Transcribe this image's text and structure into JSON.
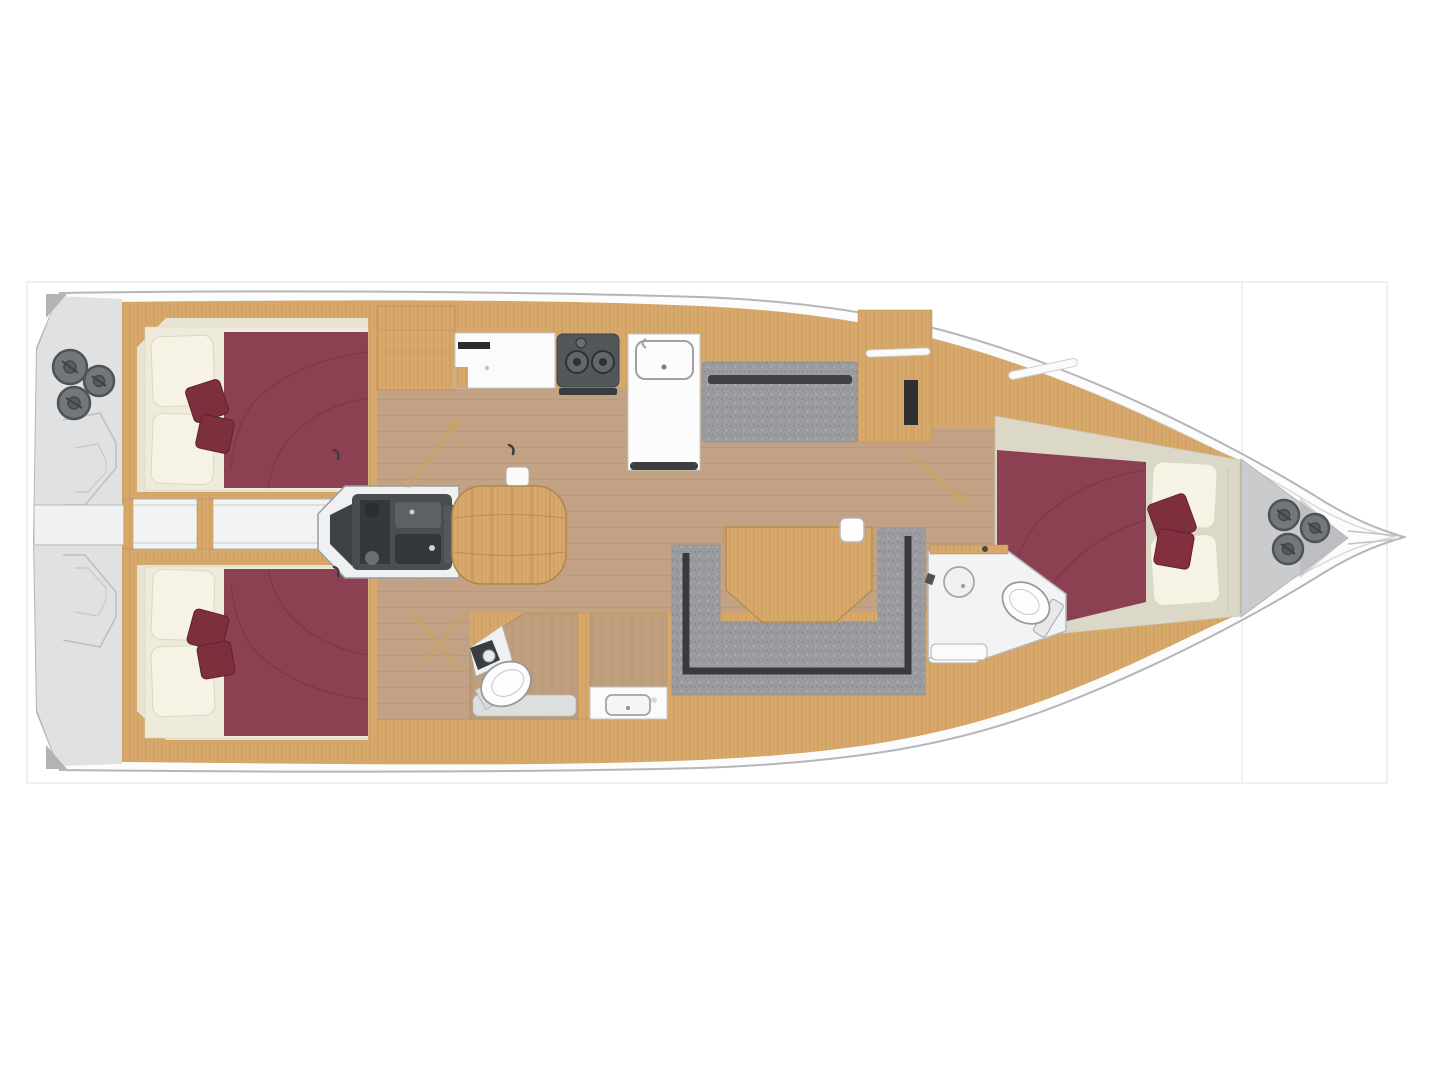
{
  "page": {
    "background": "#ffffff",
    "frame": {
      "x": 27,
      "y": 282,
      "width": 1360,
      "height": 501,
      "divider_x": 1242
    }
  },
  "plan": {
    "type": "sailing-yacht-interior-floor-plan",
    "view": "top-down",
    "bow": "right",
    "stern": "left"
  },
  "features": {
    "stern_platform": {
      "label": "stern deck / swim platform",
      "winches": 3
    },
    "aft_cabin_top": {
      "label": "aft double cabin (upper)",
      "berth": "double",
      "pillows": 2,
      "throw_cushions": 2
    },
    "aft_cabin_bottom": {
      "label": "aft double cabin (lower)",
      "berth": "double",
      "pillows": 2,
      "throw_cushions": 2
    },
    "walkway": {
      "label": "transom walkway between aft cabins"
    },
    "engine_room": {
      "label": "engine compartment"
    },
    "companionway": {
      "label": "companionway steps"
    },
    "galley": {
      "label": "galley",
      "stove_burners": 2,
      "sink": 1,
      "worktop": 1,
      "island_unit": 1
    },
    "salon": {
      "label": "salon",
      "side_bench": 1,
      "u_sofa": 1,
      "table": 1
    },
    "aft_head": {
      "label": "aft head",
      "toilet": 1,
      "corner_sink": 1,
      "shower_pan": 1
    },
    "shower_room": {
      "label": "aft shower room",
      "vanity_sink": 1
    },
    "forward_head": {
      "label": "forward head",
      "toilet": 1,
      "round_sink": 1,
      "bench": 1
    },
    "forward_cabin": {
      "label": "forward double cabin",
      "berth": "double",
      "pillows": 2,
      "throw_cushions": 2
    },
    "bow_locker": {
      "label": "anchor locker",
      "winches": 3
    }
  },
  "colors": {
    "wood": "#d8a96c",
    "woodGrain": "#bf8e50",
    "doorWood": "#c9a267",
    "floor": "#c3a184",
    "floorLine": "#ab8a68",
    "headFloor": "#bf9f7d",
    "headFloorLine": "#a9896a",
    "maroon": "#8c4153",
    "maroonSeam": "#7a3545",
    "cushion": "#7d2f3e",
    "cushionEdge": "#63202e",
    "pillow": "#f6f2e4",
    "pillowEdge": "#dcd7c3",
    "sole": "#e8e4d4",
    "bedbase": "#efebdb",
    "pocket": "#dcd8c8",
    "deck": "#e0e1e3",
    "deckDark": "#b1b3b5",
    "bowDeck": "#c9cbcd",
    "hullFill": "#fcfcfc",
    "hullStroke": "#b4b6b8",
    "hullInner": "#d8d9da",
    "winch": "#74777a",
    "winchRing": "#505356",
    "winchHub": "#595c5f",
    "engine": "#4a4e51",
    "engineDark": "#35383b",
    "sofa": "#9a9c9f",
    "sofaBack": "#303234",
    "stove": "#54575a",
    "bathFloor": "#f2f3f4",
    "shower": "#dcdee0",
    "fixture": "#fdfdfd",
    "fixtureStroke": "#98999c",
    "outline": "#b6b8ba",
    "grid": "#ebebee",
    "locker": "#2e3032",
    "white": "#fbfbfc"
  }
}
